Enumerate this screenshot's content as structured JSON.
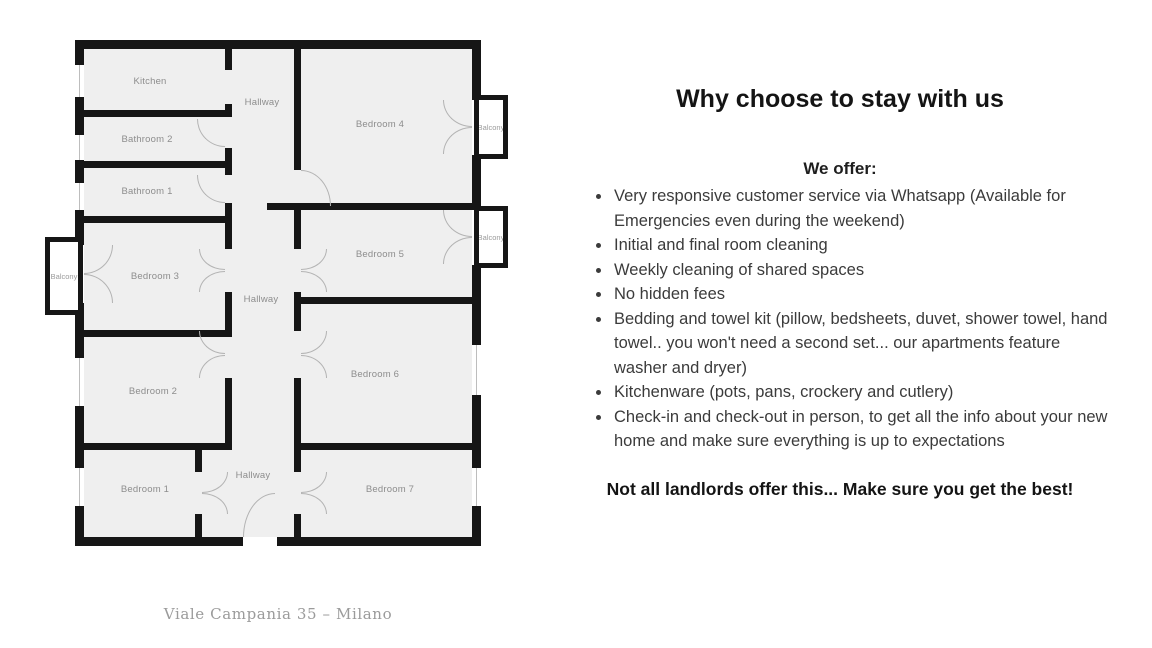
{
  "plan": {
    "rooms": {
      "kitchen": "Kitchen",
      "hallway_top": "Hallway",
      "bathroom2": "Bathroom 2",
      "bathroom1": "Bathroom 1",
      "bedroom3": "Bedroom 3",
      "hallway_mid": "Hallway",
      "bedroom2": "Bedroom 2",
      "bedroom1": "Bedroom 1",
      "hallway_bottom": "Hallway",
      "bedroom4": "Bedroom 4",
      "bedroom5": "Bedroom 5",
      "bedroom6": "Bedroom 6",
      "bedroom7": "Bedroom 7",
      "balcony_left": "Balcony",
      "balcony_top_right": "Balcony",
      "balcony_mid_right": "Balcony"
    },
    "caption": "Viale Campania 35 – Milano",
    "colors": {
      "wall": "#161616",
      "room_fill": "#efefef",
      "label": "#8d8d8d",
      "door_arc": "#b3b3b3"
    }
  },
  "content": {
    "title": "Why choose to stay with us",
    "subtitle": "We offer:",
    "bullets": [
      "Very responsive customer service via Whatsapp (Available for Emergencies even during the weekend)",
      "Initial and final room cleaning",
      "Weekly cleaning of shared spaces",
      "No hidden fees",
      "Bedding and towel kit (pillow, bedsheets, duvet, shower towel, hand towel.. you won't need a second set... our apartments feature washer and dryer)",
      "Kitchenware (pots, pans, crockery and cutlery)",
      "Check-in and check-out in person, to get all the info about your new home and make sure everything is up to expectations"
    ],
    "footer": "Not all landlords offer this... Make sure you get the best!"
  }
}
